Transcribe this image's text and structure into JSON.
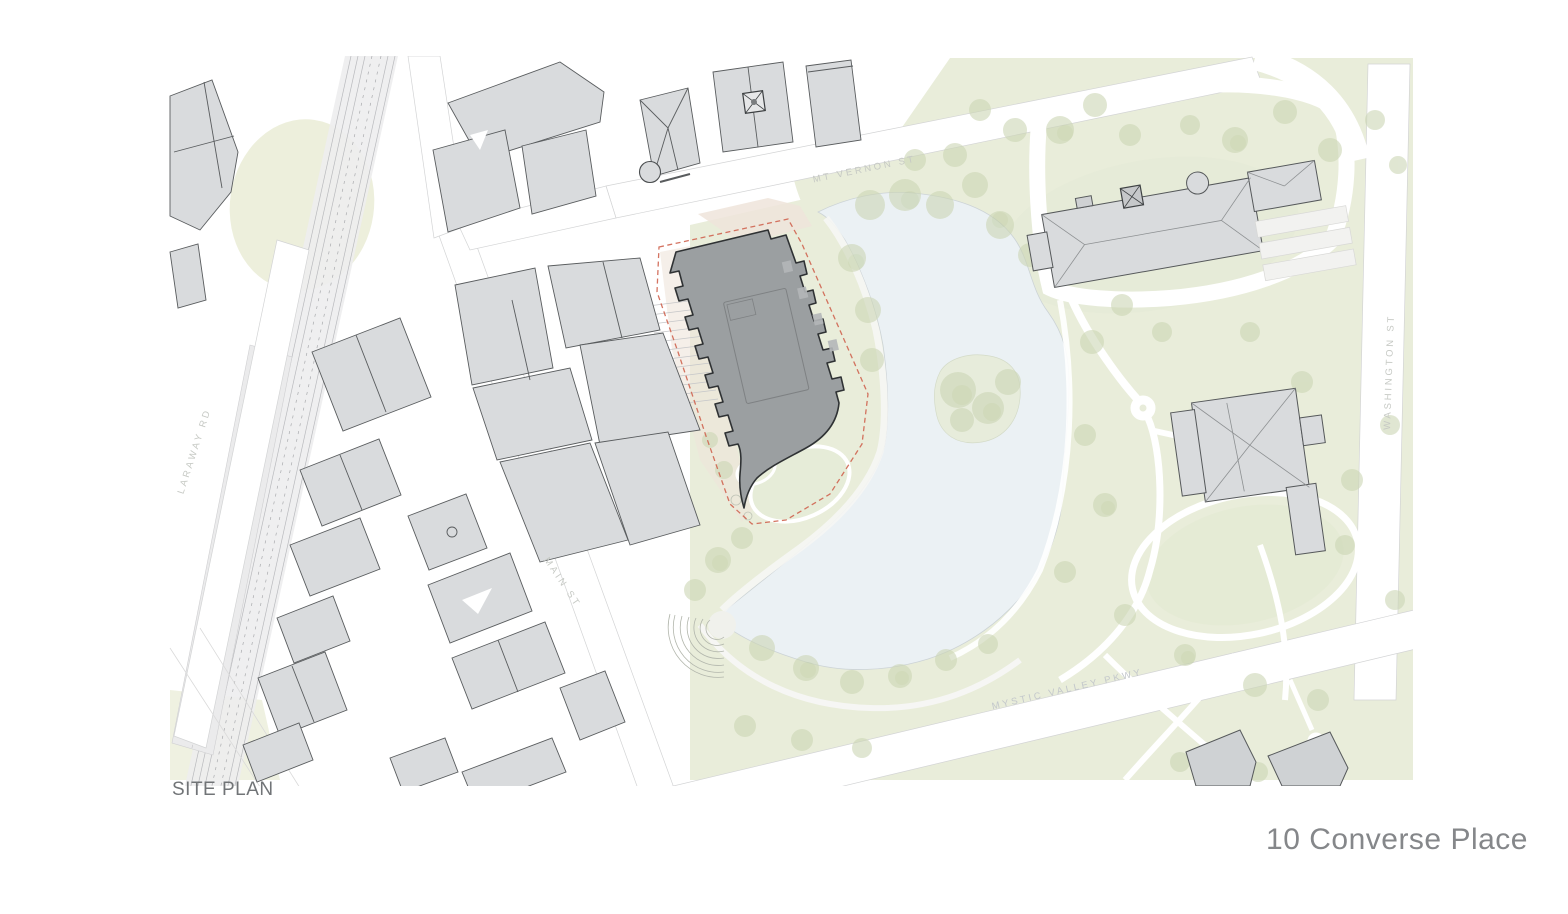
{
  "page": {
    "caption": "SITE PLAN",
    "project_title": "10 Converse Place"
  },
  "map": {
    "type": "architectural-site-plan",
    "streets": [
      {
        "name": "MT VERNON ST"
      },
      {
        "name": "WASHINGTON ST"
      },
      {
        "name": "MYSTIC VALLEY PKWY"
      },
      {
        "name": "MAIN ST"
      },
      {
        "name": "LARAWAY RD"
      }
    ],
    "features": [
      "proposed building footprint (dark gray)",
      "site boundary (red dashed line)",
      "pond with wooded island",
      "public park with lawns, paths and tree clusters",
      "amphitheater steps at pond edge",
      "railway corridor with platforms",
      "surrounding context buildings",
      "civic building with cupola and parking",
      "church building in park"
    ],
    "colors": {
      "proposed_building": "#9b9fa1",
      "context_building": "#d9dbdd",
      "site_boundary": "#cf6450",
      "pond": "#ebf1f4",
      "park_green": "#e9edda",
      "tree_green": "#ccd6b5",
      "walkway_tan": "#eee4da",
      "street_label": "#c6c9c4",
      "caption_text": "#717477",
      "title_text": "#85878a"
    }
  }
}
